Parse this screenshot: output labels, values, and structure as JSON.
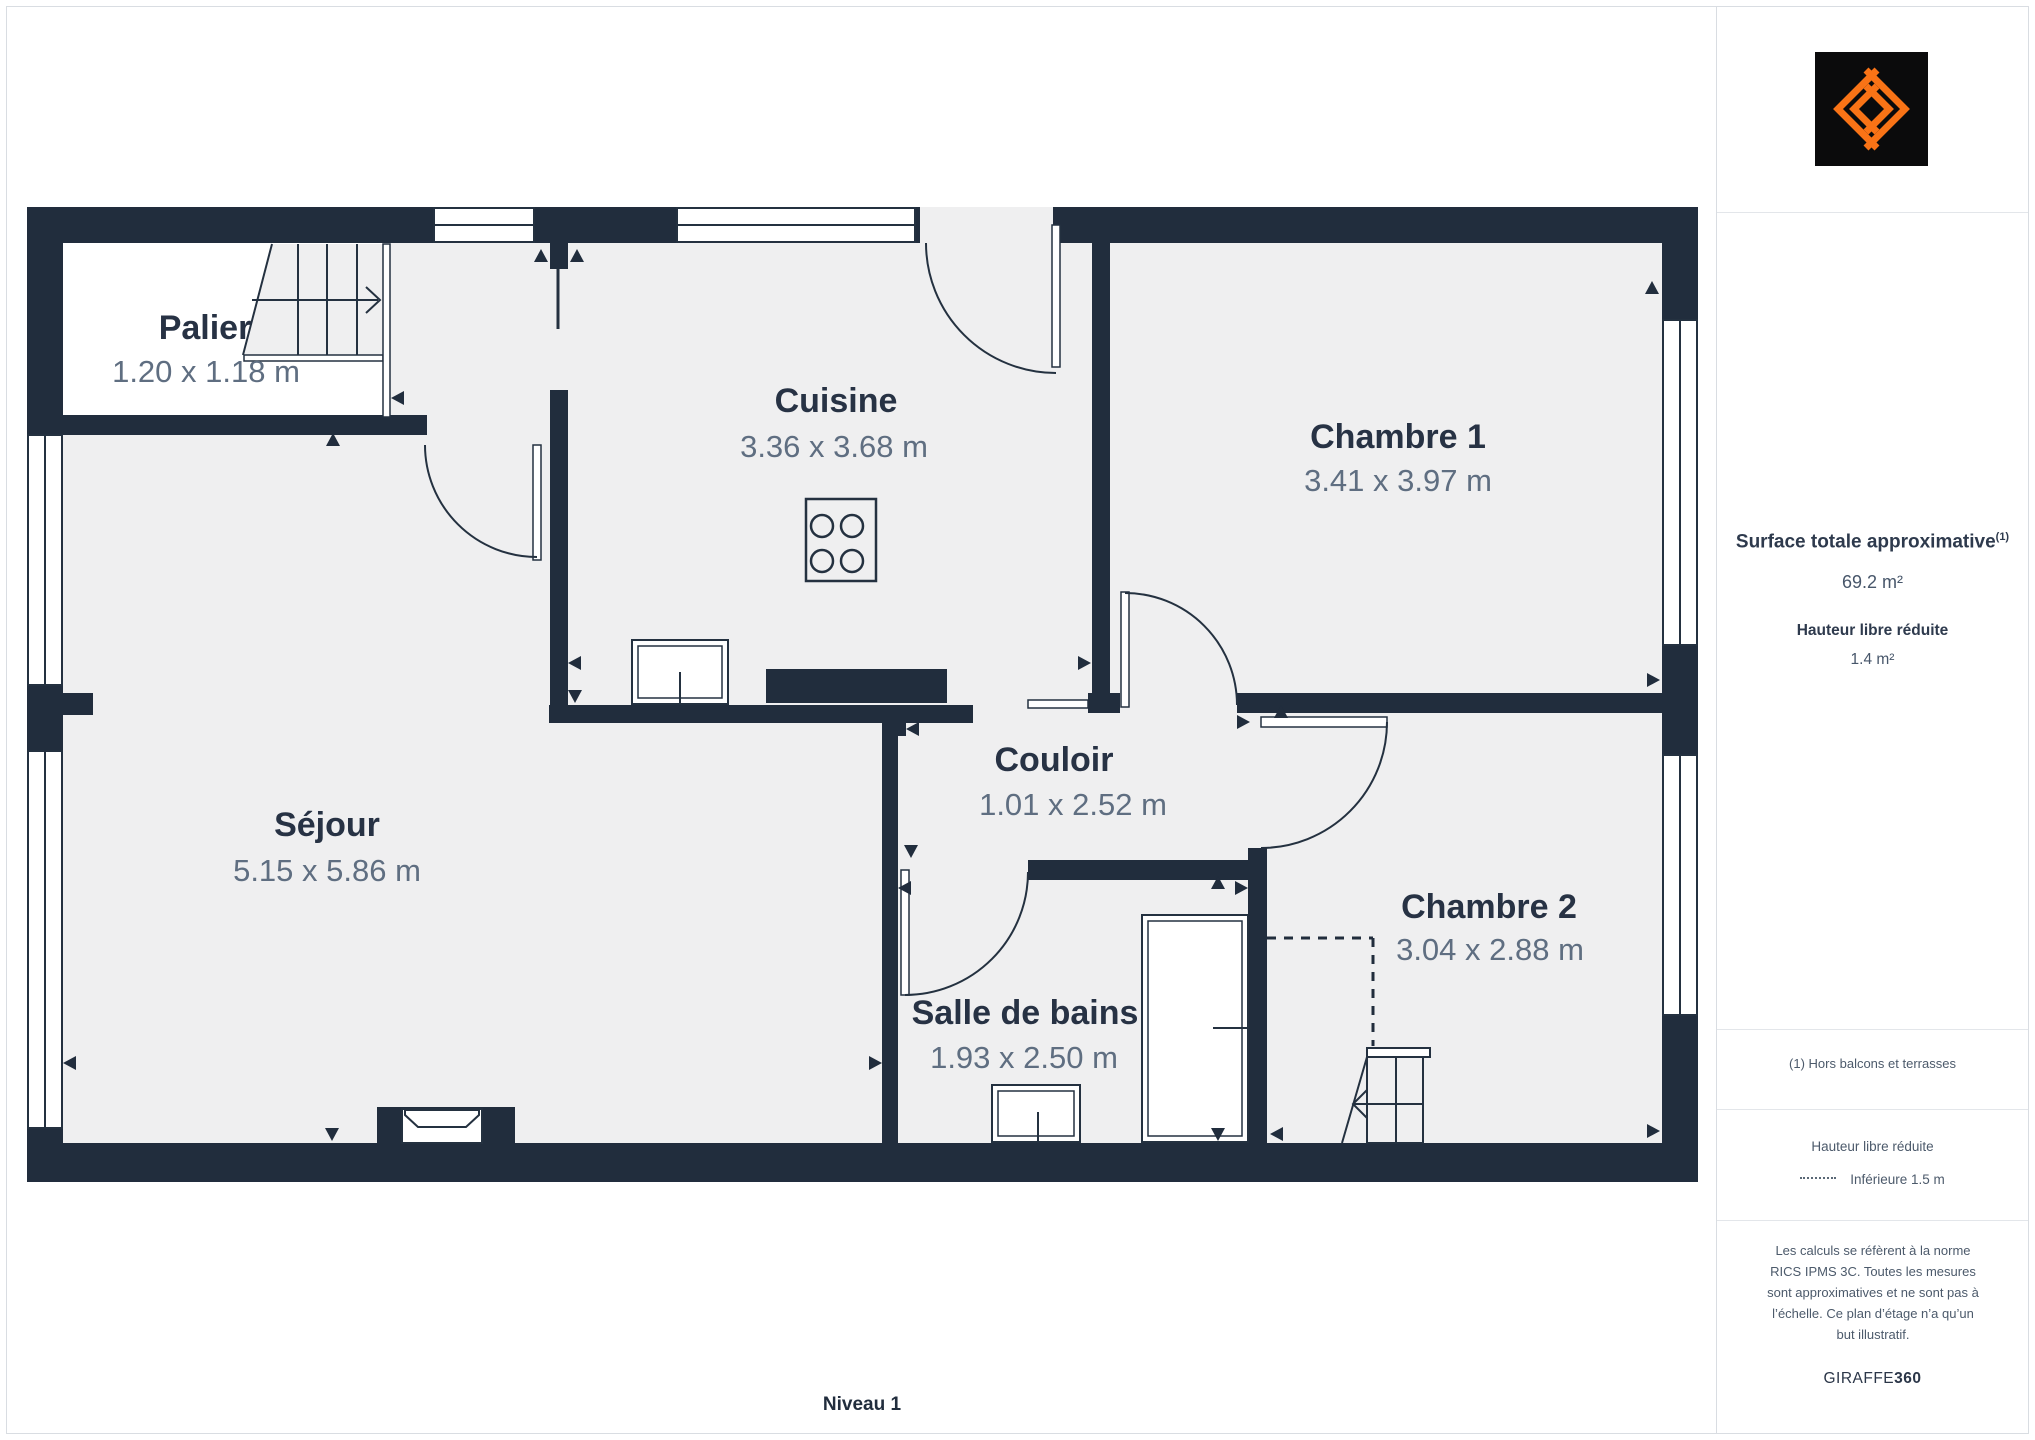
{
  "floorplan": {
    "level_label": "Niveau 1",
    "rooms": {
      "palier": {
        "name": "Palier",
        "dims": "1.20 x 1.18 m"
      },
      "cuisine": {
        "name": "Cuisine",
        "dims": "3.36 x 3.68 m"
      },
      "chambre1": {
        "name": "Chambre 1",
        "dims": "3.41 x 3.97 m"
      },
      "sejour": {
        "name": "Séjour",
        "dims": "5.15 x 5.86 m"
      },
      "couloir": {
        "name": "Couloir",
        "dims": "1.01 x 2.52 m"
      },
      "salle_de_bains": {
        "name": "Salle de bains",
        "dims": "1.93 x 2.50 m"
      },
      "chambre2": {
        "name": "Chambre 2",
        "dims": "3.04 x 2.88 m"
      }
    }
  },
  "sidebar": {
    "surface_title": "Surface totale approximative",
    "surface_superscript": "(1)",
    "surface_value": "69.2 m²",
    "reduced_height_title": "Hauteur libre réduite",
    "reduced_height_value": "1.4 m²",
    "footnote": "(1) Hors balcons et terrasses",
    "legend_title": "Hauteur libre réduite",
    "legend_item": "Inférieure 1.5 m",
    "disclaimer": "Les calculs se réfèrent à la norme RICS IPMS 3C. Toutes les mesures sont approximatives et ne sont pas à l’échelle. Ce plan d’étage n’a qu’un but illustratif.",
    "brand_regular": "GIRAFFE",
    "brand_bold": "360"
  },
  "colors": {
    "wall": "#212d3d",
    "floor": "#efeff0",
    "room_label": "#273244",
    "dims_label": "#5f6e81",
    "logo_orange": "#f97316",
    "logo_background": "#0b0b0c",
    "border": "#d9dde2"
  }
}
